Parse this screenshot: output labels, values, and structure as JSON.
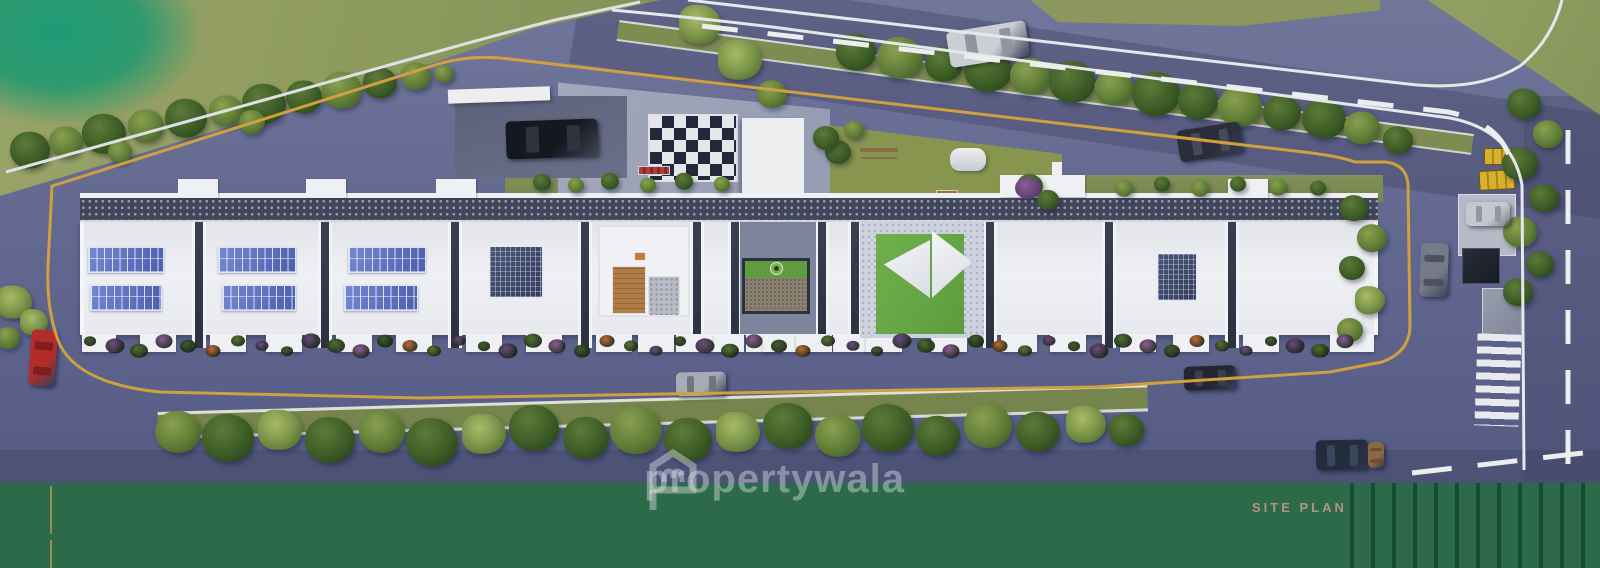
{
  "meta": {
    "kind": "3d-aerial-site-plan-render",
    "description": "Top-down 3D rendered site plan of a long linear apartment complex with rooftop solar panels and roof courtyards, ringed by an internal driveway with yellow edge lines, tree-lined boundary roads, vehicles, lawns and a green title band"
  },
  "footer": {
    "label": "SITE PLAN",
    "background": "#2c6a49",
    "stripe_color": "#1d5a3b",
    "label_color": "#b19488",
    "accent_line_color": "#a08a50"
  },
  "watermark": {
    "logo": "propertywala-house-logo",
    "text": "propertywala",
    "color": "rgba(228,230,235,0.42)"
  },
  "palette": {
    "asphalt": "#666b92",
    "lane_marking_yellow": "#d0a03f",
    "lane_marking_white": "#e8e9ee",
    "lawn_olive": "#97a163",
    "lawn_bright_teal": "#27996e",
    "roof_white": "#e9ebef",
    "solar_panel_blue": "#5a6db8",
    "rooftop_grating": "#41465a",
    "courtyard_lawn": "#68ab45",
    "deck_timber": "#b07c46",
    "tree_dark": "#33511f",
    "tree_light": "#7e9a4b",
    "car_red": "#b32b2b",
    "bus_yellow": "#d9b02e"
  },
  "scene": {
    "building": {
      "blocks": 7,
      "roof_courtyards": 3,
      "solar_array_blocks": 4,
      "features": [
        "rooftop solar panel arrays",
        "perforated rooftop service strip",
        "stair bulkheads",
        "colorful balcony planters"
      ]
    },
    "amenities": [
      "checkered entry plaza with central tree",
      "drop-off driveway with parked car",
      "children's play lawn with swing and vault",
      "roof seating court with four round tables",
      "timber deck and pebble court",
      "framed lawn-and-gravel court",
      "shade-sail lawn court with benches",
      "visitor parking pad",
      "zebra pedestrian crossing"
    ],
    "roads": {
      "internal_loop": "grey driveway loop with yellow edge line around the building",
      "main_road": "two-lane dashed road along the north-east boundary",
      "south_road": "tree-lined road along the south boundary",
      "east_road": "road along the east boundary with dashed line"
    },
    "vehicles": [
      {
        "type": "car",
        "color": "red",
        "location": "west loop"
      },
      {
        "type": "car",
        "color": "black",
        "location": "north drop-off"
      },
      {
        "type": "car",
        "color": "silver",
        "location": "main road"
      },
      {
        "type": "car",
        "color": "dark-grey",
        "location": "main road"
      },
      {
        "type": "car",
        "color": "grey",
        "location": "east loop"
      },
      {
        "type": "car",
        "color": "silver",
        "location": "east parking pad"
      },
      {
        "type": "bus",
        "color": "yellow",
        "location": "east gate"
      },
      {
        "type": "bus",
        "color": "yellow",
        "location": "east gate"
      },
      {
        "type": "car",
        "color": "grey",
        "location": "south loop"
      },
      {
        "type": "car",
        "color": "black",
        "location": "south road"
      },
      {
        "type": "truck",
        "color": "dark-blue",
        "location": "south-east road"
      }
    ],
    "vegetation": {
      "tree_rows": [
        "north-west boundary",
        "main-road median",
        "east boundary",
        "south median",
        "east end of building"
      ],
      "lawns": [
        "north-west lawn with bright corner",
        "north-east verge",
        "rooftop play lawn"
      ]
    }
  }
}
